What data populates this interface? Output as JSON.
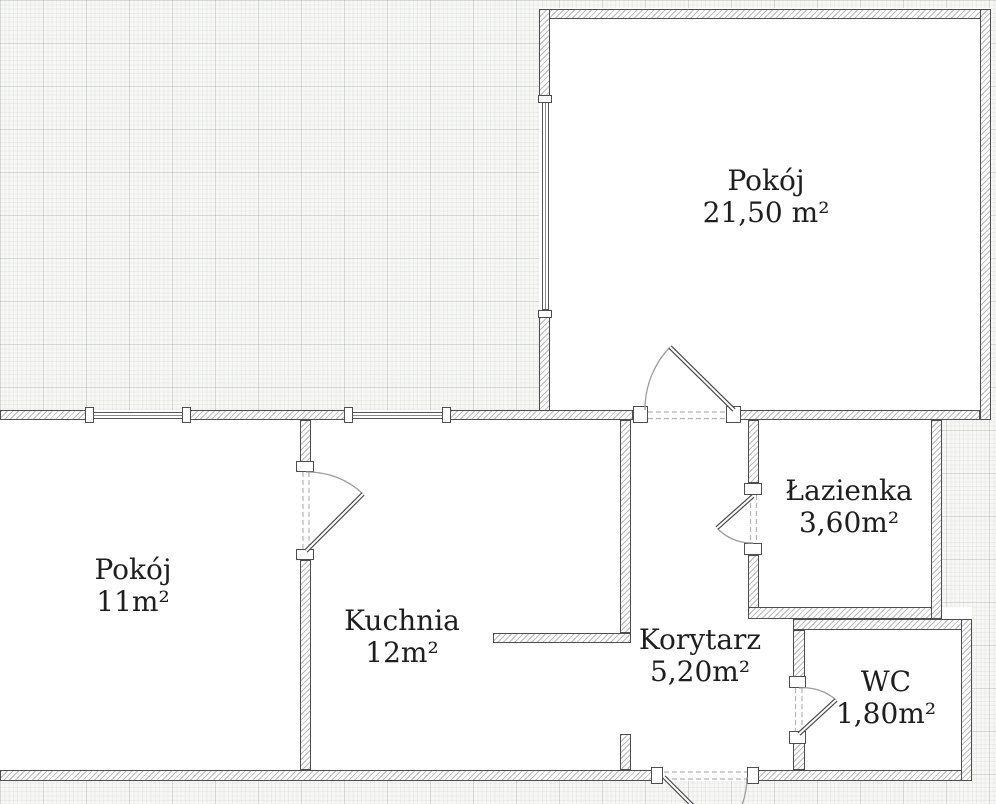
{
  "plan": {
    "type": "apartment-floor-plan",
    "language": "pl"
  },
  "rooms": {
    "pokoj_large": {
      "name": "Pokój",
      "area": "21,50 m²"
    },
    "pokoj_small": {
      "name": "Pokój",
      "area": "11m²"
    },
    "kuchnia": {
      "name": "Kuchnia",
      "area": "12m²"
    },
    "korytarz": {
      "name": "Korytarz",
      "area": "5,20m²"
    },
    "lazienka": {
      "name": "Łazienka",
      "area": "3,60m²"
    },
    "wc": {
      "name": "WC",
      "area": "1,80m²"
    }
  },
  "colors": {
    "background_paper": "#f7f7f5",
    "grid_line": "#dde0dd",
    "wall_outline": "#4e4e4e",
    "wall_hatch": "#b7b7b7",
    "room_floor": "#ffffff",
    "label_text": "#1e1e1e",
    "door_arc": "#9d9d9d"
  }
}
